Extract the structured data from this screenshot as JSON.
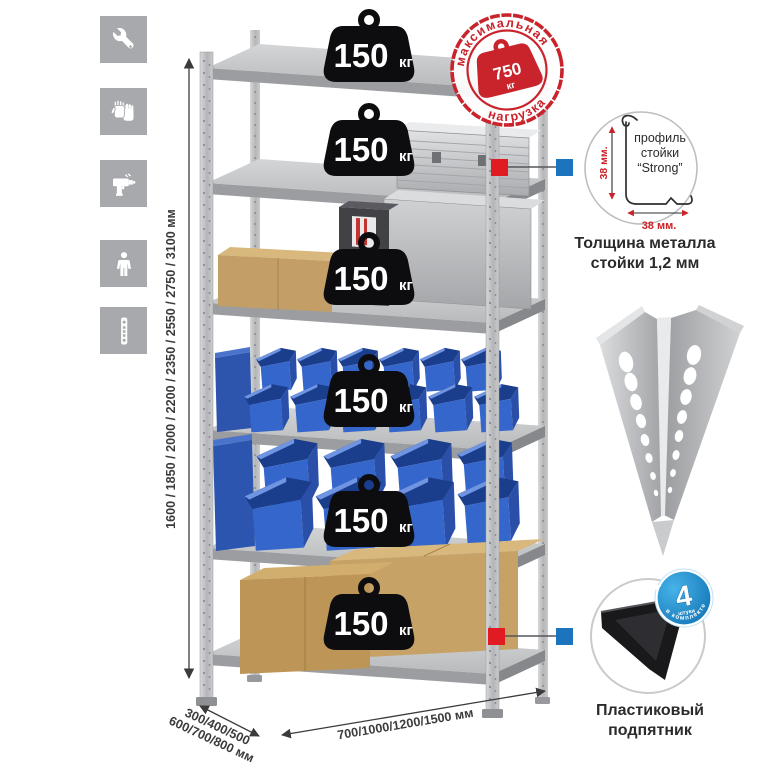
{
  "infographic": {
    "background": "#ffffff"
  },
  "feature_icons": {
    "tile_color": "#a7a9ac",
    "items": [
      {
        "name": "wrench-icon"
      },
      {
        "name": "gloves-icon"
      },
      {
        "name": "drill-icon"
      },
      {
        "name": "person-icon"
      },
      {
        "name": "perforated-post-icon"
      }
    ]
  },
  "height_dimension": {
    "label": "1600 / 1850 / 2000 / 2200 / 2350 / 2550 / 2750 / 3100 мм"
  },
  "rack": {
    "shelves": 6,
    "weights": [
      {
        "value": "150",
        "unit": "кг"
      },
      {
        "value": "150",
        "unit": "кг"
      },
      {
        "value": "150",
        "unit": "кг"
      },
      {
        "value": "150",
        "unit": "кг"
      },
      {
        "value": "150",
        "unit": "кг"
      },
      {
        "value": "150",
        "unit": "кг"
      }
    ]
  },
  "max_load_stamp": {
    "arc_top": "максимальная",
    "arc_bottom": "нагрузка",
    "value": "750",
    "unit": "кг",
    "color": "#c9232b"
  },
  "profile_callout": {
    "line1": "профиль",
    "line2": "стойки",
    "line3": "“Strong”",
    "vertical_dim": "38 мм.",
    "horizontal_dim": "38 мм.",
    "dim_color": "#cc2127",
    "caption_line1": "Толщина металла",
    "caption_line2": "стойки 1,2 мм"
  },
  "foot_callout": {
    "badge_value": "4",
    "badge_sub": "штуки",
    "badge_arc": "в комплекте",
    "badge_color": "#1787c9",
    "caption_line1": "Пластиковый",
    "caption_line2": "подпятник"
  },
  "depth_dimension": {
    "line1": "300/400/500",
    "line2": "600/700/800 мм"
  },
  "width_dimension": {
    "label": "700/1000/1200/1500 мм"
  },
  "callout_markers": {
    "red": "#e11b22",
    "blue": "#1c75bc"
  }
}
